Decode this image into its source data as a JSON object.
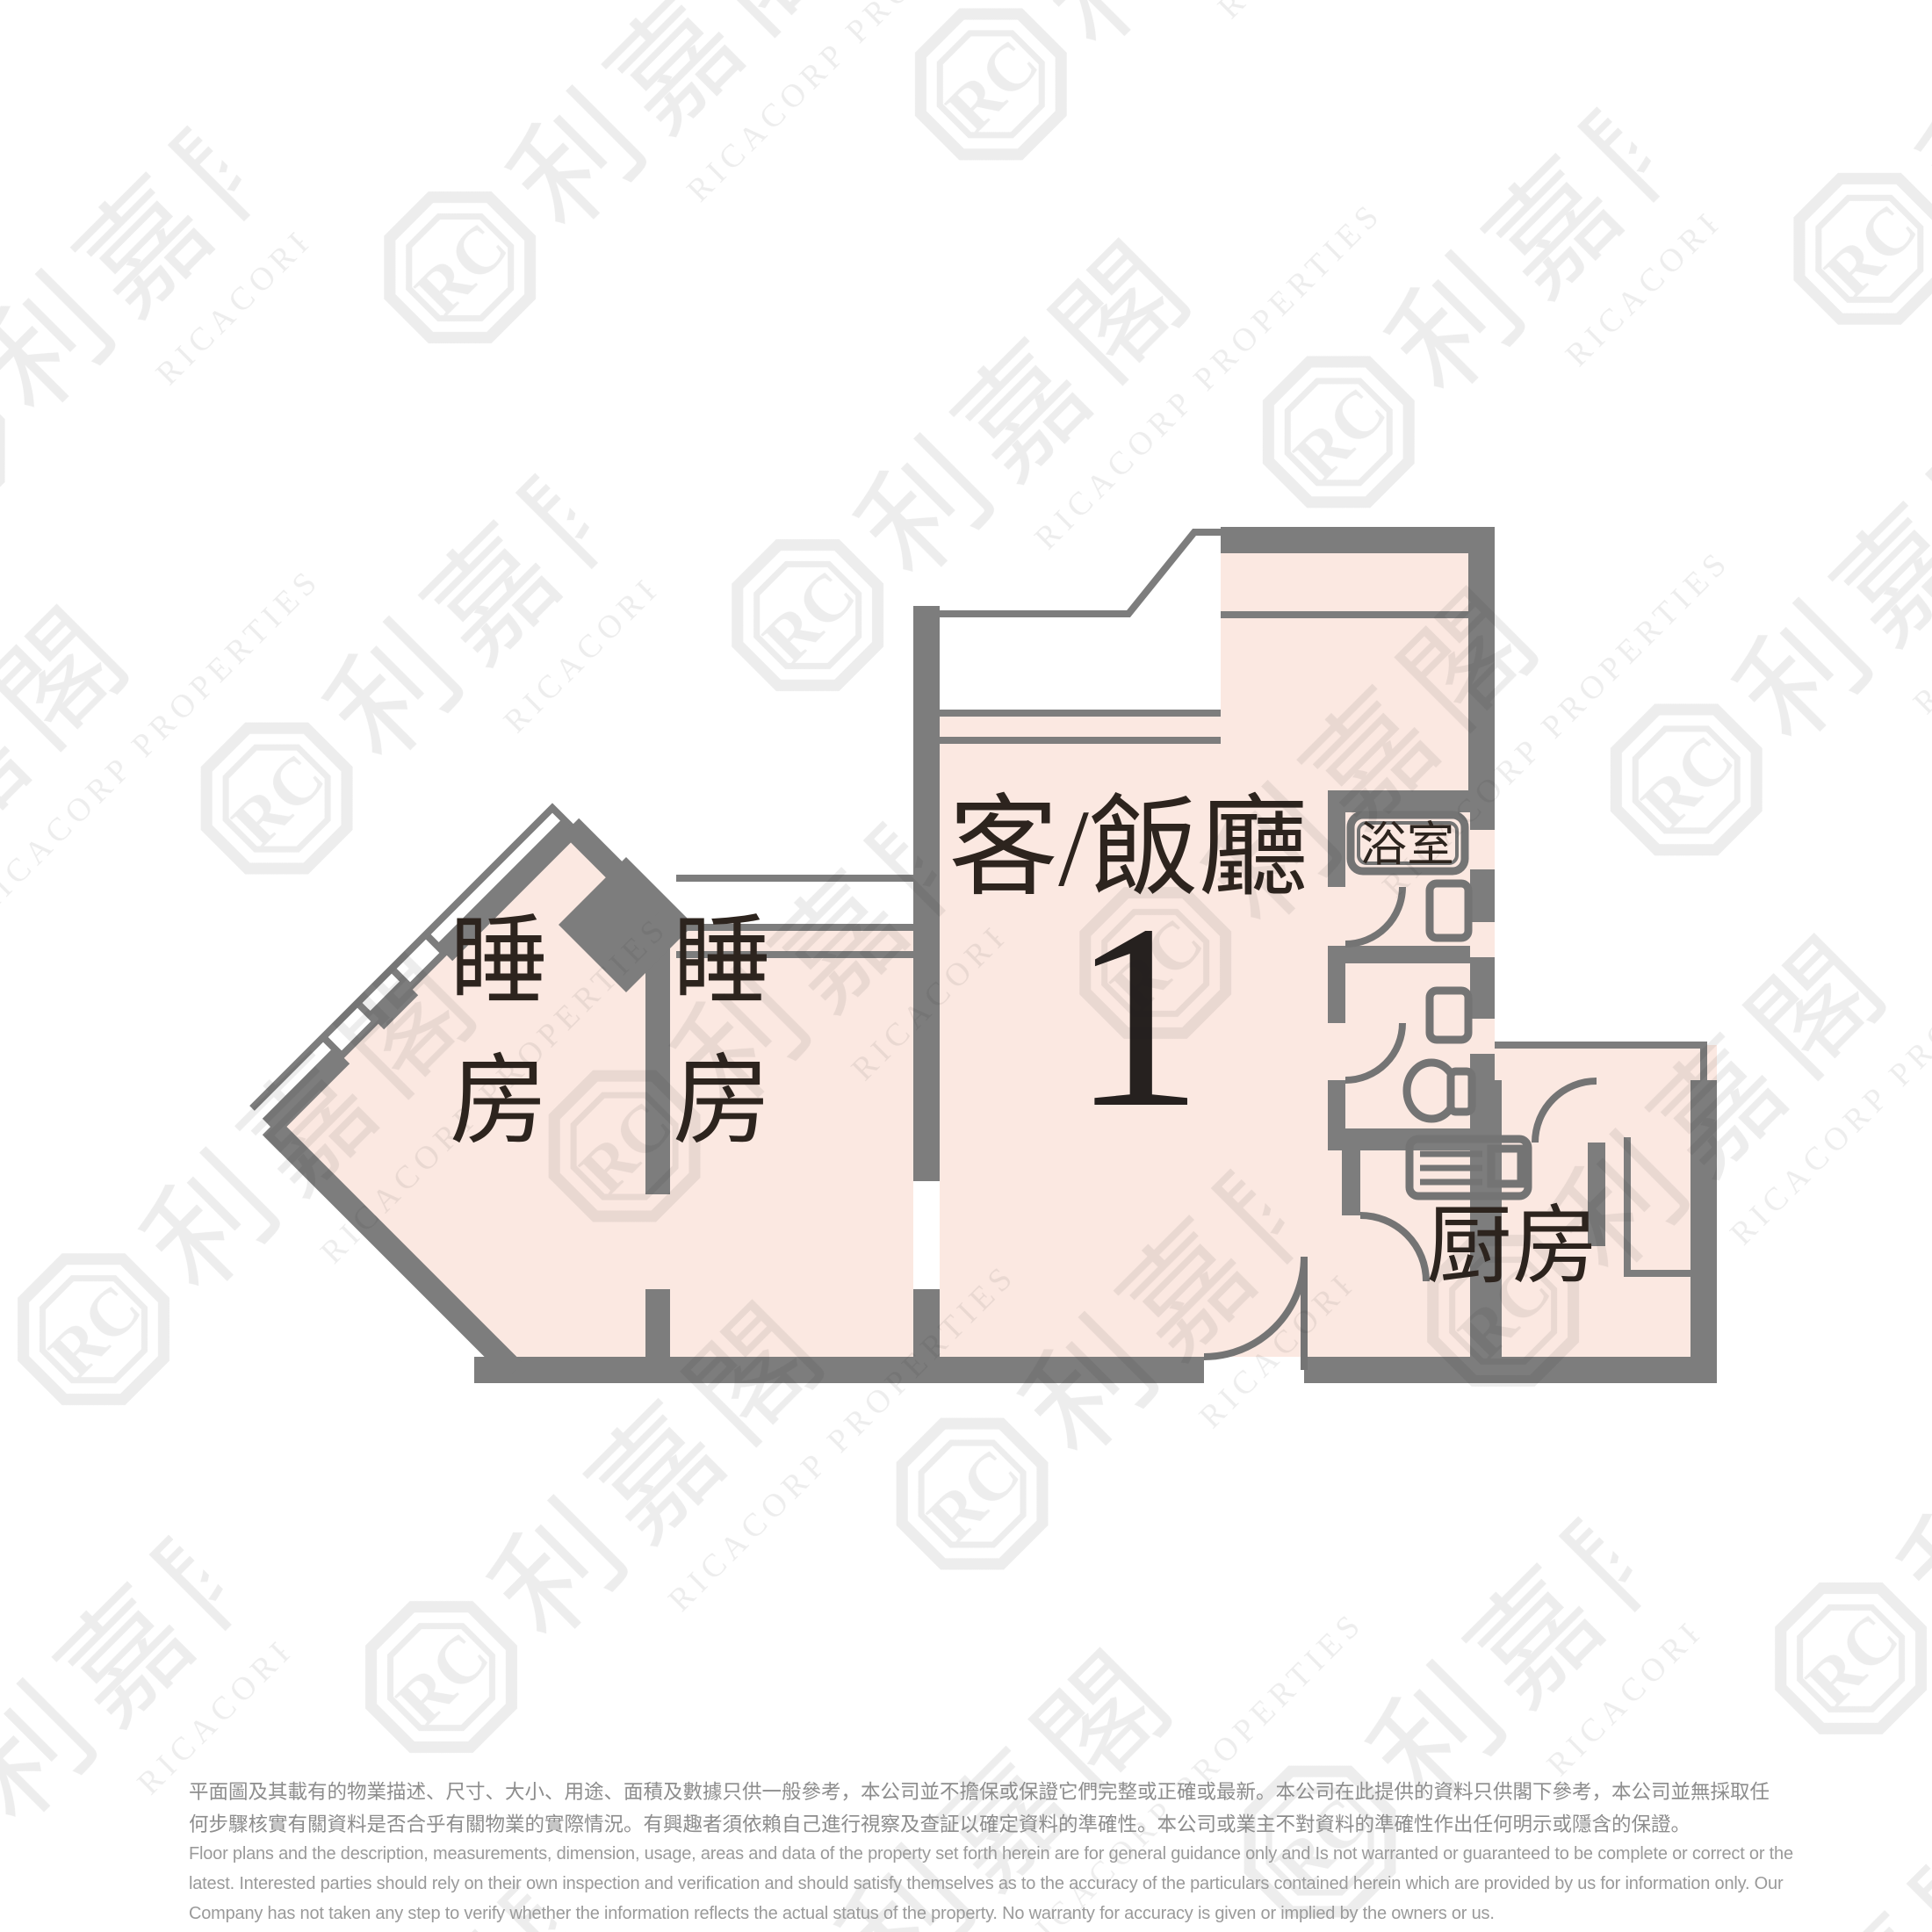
{
  "floor_plan": {
    "rooms": {
      "living_dining": {
        "label": "客/飯廳",
        "unit_number": "1"
      },
      "bedroom_left": {
        "char_top": "睡",
        "char_bottom": "房"
      },
      "bedroom_middle": {
        "char_top": "睡",
        "char_bottom": "房"
      },
      "bathroom": {
        "label": "浴室"
      },
      "kitchen": {
        "label": "厨房"
      }
    },
    "colors": {
      "wall_gray": "#7d7d7d",
      "floor_pink": "#fbe8e1",
      "fixture_gray": "#747474",
      "label_dark": "#2d241e"
    }
  },
  "watermark": {
    "logo_monogram": "RC",
    "cjk": "利嘉閣",
    "latin": "RICACORP PROPERTIES"
  },
  "disclaimer": {
    "zh": [
      "平面圖及其載有的物業描述、尺寸、大小、用途、面積及數據只供一般參考，本公司並不擔保或保證它們完整或正確或最新。本公司在此提供的資料只供閣下參考，本公司並無採取任",
      "何步驟核實有關資料是否合乎有關物業的實際情況。有興趣者須依賴自己進行視察及查証以確定資料的準確性。本公司或業主不對資料的準確性作出任何明示或隱含的保證。"
    ],
    "en": [
      "Floor plans and the description, measurements, dimension, usage, areas and data of the property set forth herein are for general guidance only and Is not warranted or guaranteed to be complete or correct or the",
      "latest. Interested parties should rely on their own inspection and verification and should satisfy themselves as to the accuracy of the particulars contained herein which are provided by us for information only.  Our",
      "Company has not taken any step to verify whether the information reflects the actual status of the property.  No warranty for accuracy is given or implied by the owners or us."
    ]
  }
}
